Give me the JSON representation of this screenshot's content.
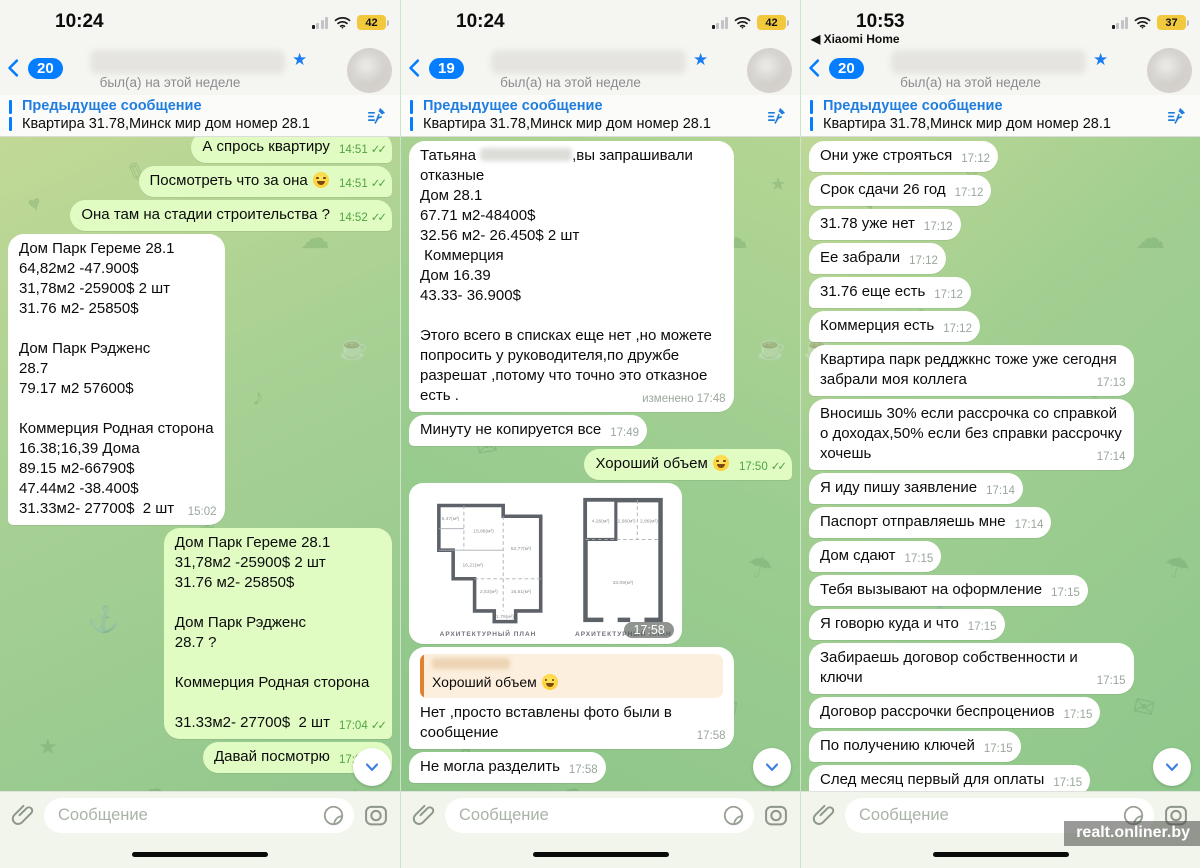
{
  "watermark": "realt.onliner.by",
  "chrome": {
    "read_checks": "✓✓",
    "edited_label": "изменено"
  },
  "colors": {
    "accent_blue": "#057dff",
    "outgoing_bubble": "#e1fcc3",
    "incoming_bubble": "#ffffff",
    "battery_yellow": "#f2c93d",
    "quote_orange": "#e0812f"
  },
  "panels": [
    {
      "status_bar": {
        "time": "10:24",
        "battery": "42"
      },
      "nav": {
        "badge": "20",
        "presence": "был(а) на этой неделе"
      },
      "pinned": {
        "title": "Предыдущее сообщение",
        "text": "Квартира 31.78,Минск мир дом номер 28.1"
      },
      "composer": {
        "placeholder": "Сообщение"
      },
      "messages": [
        {
          "dir": "out",
          "text": "А спрось квартиру",
          "time": "14:51",
          "checks": true
        },
        {
          "dir": "out",
          "text": "Посмотреть что за она 😅",
          "time": "14:51",
          "checks": true
        },
        {
          "dir": "out",
          "text": "Она там на стадии строительства ?",
          "time": "14:52",
          "checks": true
        },
        {
          "dir": "in",
          "text": "Дом Парк Гереме 28.1\n64,82м2 -47.900$\n31,78м2 -25900$ 2 шт\n31.76 м2- 25850$\n\nДом Парк Рэдженс\n28.7\n79.17 м2 57600$\n\nКоммерция Родная сторона\n16.38;16,39 Дома\n89.15 м2-66790$\n47.44м2 -38.400$\n31.33м2- 27700$  2 шт",
          "time": "15:02"
        },
        {
          "dir": "out",
          "text": "Дом Парк Гереме 28.1\n31,78м2 -25900$ 2 шт\n31.76 м2- 25850$\n\nДом Парк Рэдженс\n28.7 ?\n\nКоммерция Родная сторона\n\n31.33м2- 27700$  2 шт",
          "time": "17:04",
          "checks": true
        },
        {
          "dir": "out",
          "text": "Давай посмотрю",
          "time": "17:04",
          "checks": true
        }
      ]
    },
    {
      "status_bar": {
        "time": "10:24",
        "battery": "42"
      },
      "nav": {
        "badge": "19",
        "presence": "был(а) на этой неделе"
      },
      "pinned": {
        "title": "Предыдущее сообщение",
        "text": "Квартира 31.78,Минск мир дом номер 28.1"
      },
      "composer": {
        "placeholder": "Сообщение"
      },
      "messages": [
        {
          "dir": "in",
          "prefix": "Татьяна ",
          "blur_inline": true,
          "text": ",вы запрашивали\nотказные\nДом 28.1\n67.71 м2-48400$\n32.56 м2- 26.450$ 2 шт\n Коммерция\nДом 16.39\n43.33- 36.900$\n\nЭтого всего в списках еще нет ,но можете попросить у руководителя,по дружбе разрешат ,потому что точно это отказное есть .",
          "time": "17:48",
          "edited": true
        },
        {
          "dir": "in",
          "text": "Минуту не копируется все",
          "time": "17:49"
        },
        {
          "dir": "out",
          "text": "Хороший объем 😅",
          "time": "17:50",
          "checks": true
        },
        {
          "type": "photo",
          "dir": "in",
          "time": "17:58",
          "captions": [
            "АРХИТЕКТУРНЫЙ ПЛАН",
            "АРХИТЕКТУРНЫЙ ПЛАН"
          ],
          "areas_left": [
            "6,47(м²)",
            "15,86(м²)",
            "16,21(м²)",
            "52,77(м²)",
            "2,53(м²)",
            "16,61(м²)",
            "1,79(м²)"
          ],
          "areas_right": [
            "4,26(м²)",
            "2,96(м²)",
            "2,86(м²)",
            "33,09(м²)"
          ]
        },
        {
          "dir": "in",
          "quote": "Хороший объем 😅",
          "text": "Нет ,просто вставлены фото были в сообщение",
          "time": "17:58"
        },
        {
          "dir": "in",
          "text": "Не могла разделить",
          "time": "17:58"
        }
      ]
    },
    {
      "status_bar": {
        "time": "10:53",
        "battery": "37",
        "back_app": "Xiaomi Home"
      },
      "nav": {
        "badge": "20",
        "presence": "был(а) на этой неделе"
      },
      "pinned": {
        "title": "Предыдущее сообщение",
        "text": "Квартира 31.78,Минск мир дом номер 28.1"
      },
      "composer": {
        "placeholder": "Сообщение"
      },
      "messages": [
        {
          "dir": "in",
          "text": "Они уже строяться",
          "time": "17:12"
        },
        {
          "dir": "in",
          "text": "Срок сдачи 26 год",
          "time": "17:12"
        },
        {
          "dir": "in",
          "text": "31.78 уже нет",
          "time": "17:12"
        },
        {
          "dir": "in",
          "text": "Ее забрали",
          "time": "17:12"
        },
        {
          "dir": "in",
          "text": "31.76 еще есть",
          "time": "17:12"
        },
        {
          "dir": "in",
          "text": "Коммерция есть",
          "time": "17:12"
        },
        {
          "dir": "in",
          "text": "Квартира парк редджкнс тоже уже сегодня забрали моя коллега",
          "time": "17:13"
        },
        {
          "dir": "in",
          "text": "Вносишь 30% если рассрочка со справкой о доходах,50% если без справки рассрочку хочешь",
          "time": "17:14"
        },
        {
          "dir": "in",
          "text": "Я иду пишу заявление",
          "time": "17:14"
        },
        {
          "dir": "in",
          "text": "Паспорт отправляешь мне",
          "time": "17:14"
        },
        {
          "dir": "in",
          "text": "Дом сдают",
          "time": "17:15"
        },
        {
          "dir": "in",
          "text": "Тебя вызывают на оформление",
          "time": "17:15"
        },
        {
          "dir": "in",
          "text": "Я говорю куда и что",
          "time": "17:15"
        },
        {
          "dir": "in",
          "text": "Забираешь договор собственности и ключи",
          "time": "17:15"
        },
        {
          "dir": "in",
          "text": "Договор рассрочки беспроцениов",
          "time": "17:15"
        },
        {
          "dir": "in",
          "text": "По получению ключей",
          "time": "17:15"
        },
        {
          "dir": "in",
          "text": "След месяц первый для оплаты",
          "time": "17:15"
        },
        {
          "dir": "in",
          "text": "Равными долями счет скажут куда в мтб",
          "time": ""
        }
      ]
    }
  ]
}
